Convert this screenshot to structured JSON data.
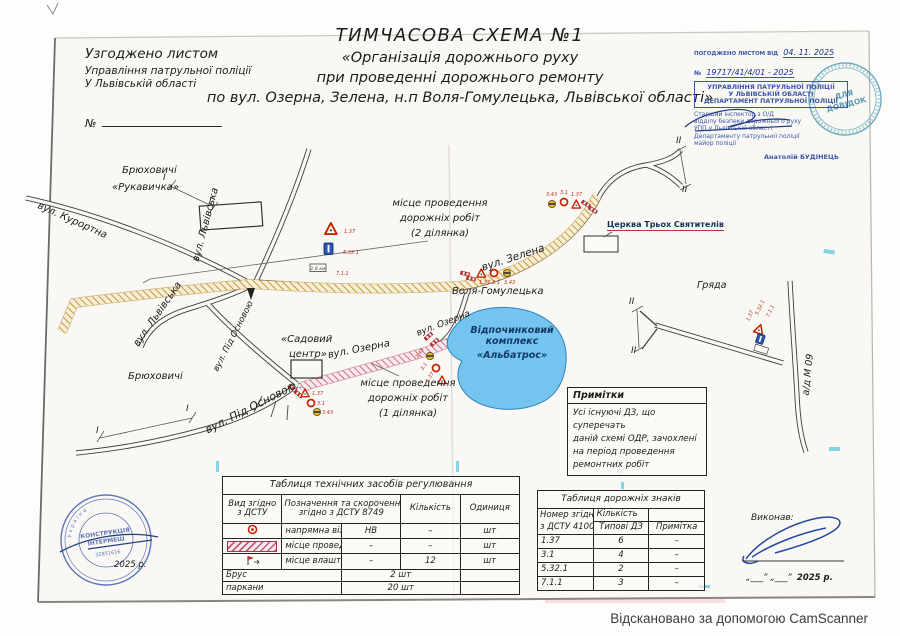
{
  "colors": {
    "stamp_blue": "#3b55a8",
    "stamp_teal": "#4b9ab2",
    "hatch_yellow": "#c49a3e",
    "hatch_pink": "#c25b74",
    "lake_blue": "#74c4ef",
    "sign_red": "#cc2200"
  },
  "approval_left": {
    "line1": "Узгоджено листом",
    "line2": "Управління патрульної поліції",
    "line3": "У Львівській області",
    "number_label": "№"
  },
  "title": {
    "line1": "ТИМЧАСОВА СХЕМА №1",
    "line2": "«Організація дорожнього руху",
    "line3": "при проведенні дорожнього ремонту",
    "line4": "по вул. Озерна, Зелена, н.п Воля-Гомулецька, Львівської області»"
  },
  "stamp_top_right": {
    "agreed_label": "ПОГОДЖЕНО ЛИСТОМ ВІД",
    "agreed_date": "04. 11. 2025",
    "number_prefix": "№",
    "number_value": "19717/41/4/01 - 2025",
    "org_lines": [
      "УПРАВЛІННЯ ПАТРУЛЬНОЇ ПОЛІЦІЇ",
      "У ЛЬВІВСЬКІЙ ОБЛАСТІ",
      "ДЕПАРТАМЕНТ ПАТРУЛЬНОЇ ПОЛІЦІЇ"
    ],
    "officer_lines": [
      "Старший інспектор з О/Д",
      "відділу безпеки дорожнього руху",
      "УПП у Львівській області",
      "Департаменту патрульної поліції",
      "майор поліції"
    ],
    "officer_name": "Анатолій БУДІНЕЦЬ",
    "round_line1": "ДЛЯ",
    "round_line2": "ДОВІДОК"
  },
  "map": {
    "labels": {
      "bryukhovychi_top_1": "Брюховичі",
      "bryukhovychi_top_2": "«Рукавичка»",
      "kurortna": "вул. Курортна",
      "lvivska_1": "вул. Львівська",
      "lvivska_2": "вул. Львівська",
      "pid_osnovoyu_1": "вул. Під Основою",
      "pid_osnovoyu_2": "вул. Під Основою",
      "bryukhovychi_low": "Брюховичі",
      "sadovyi_1": "«Садовий",
      "sadovyi_2": "центр»",
      "ozerna_1": "вул. Озерна",
      "ozerna_2": "вул. Озерна",
      "zelena": "вул. Зелена",
      "volya": "Воля-Гомулецька",
      "church": "Церква Трьох Святителів",
      "albatros_1": "Відпочинковий комплекс",
      "albatros_2": "«Альбатрос»",
      "hryada": "Гряда",
      "m09": "а/д М 09",
      "works2_1": "місце проведення",
      "works2_2": "дорожніх робіт",
      "works2_3": "(2 ділянка)",
      "works1_1": "місце проведення",
      "works1_2": "дорожніх робіт",
      "works1_3": "(1 ділянка)",
      "section_i": "І",
      "section_ii": "ІІ"
    },
    "codes": {
      "n137": "1.37",
      "n31": "3.1",
      "n343": "3.43",
      "n5321": "5.32.1",
      "n711": "7.1.1"
    },
    "plate_value": "1,8 км"
  },
  "notes": {
    "title": "Примітки",
    "lines": [
      "Усі існуючі ДЗ, що суперечать",
      "даній схемі ОДР, зачохлені",
      "на період проведення",
      "ремонтних робіт"
    ]
  },
  "table_controls": {
    "title": "Таблиця технічних засобів регулювання",
    "col_type_1": "Вид згідно",
    "col_type_2": "з ДСТУ",
    "col_desc_1": "Позначення та скорочення",
    "col_desc_2": "згідно з ДСТУ 8749",
    "col_qty": "Кількість",
    "col_unit": "Одиниця",
    "rows": [
      {
        "name": "напрямна віха, конус",
        "abbr": "НВ",
        "qty": "–",
        "unit": "шт"
      },
      {
        "name": "місце проведення робіт",
        "abbr": "–",
        "qty": "–",
        "unit": "шт"
      },
      {
        "name": "місце влаштування ДЗ",
        "abbr": "–",
        "qty": "12",
        "unit": "шт"
      },
      {
        "name": "Брус",
        "qty": "2 шт"
      },
      {
        "name": "паркани",
        "qty": "20 шт"
      }
    ]
  },
  "table_signs": {
    "title": "Таблиця дорожніх знаків",
    "col_num_1": "Номер згідно",
    "col_num_2": "з ДСТУ 4100",
    "col_qty": "Кількість",
    "col_typical": "Типові ДЗ",
    "col_note": "Примітка",
    "rows": [
      {
        "num": "1.37",
        "qty": "6",
        "note": "–"
      },
      {
        "num": "3.1",
        "qty": "4",
        "note": "–"
      },
      {
        "num": "5.32.1",
        "qty": "2",
        "note": "–"
      },
      {
        "num": "7.1.1",
        "qty": "3",
        "note": "–"
      }
    ]
  },
  "footer": {
    "executor_label": "Виконав:",
    "date_blanks": "„___”  „___”",
    "year_right": "2025 р.",
    "year_left": "2025 р.",
    "stamp": {
      "ring_text": "· Україна ·",
      "inner_1": "КОНСТРУКЦІЯ",
      "inner_2": "ІНТЕРМЕШ",
      "code": "32851616"
    }
  },
  "scanner_note": "Відскановано за допомогою CamScanner"
}
